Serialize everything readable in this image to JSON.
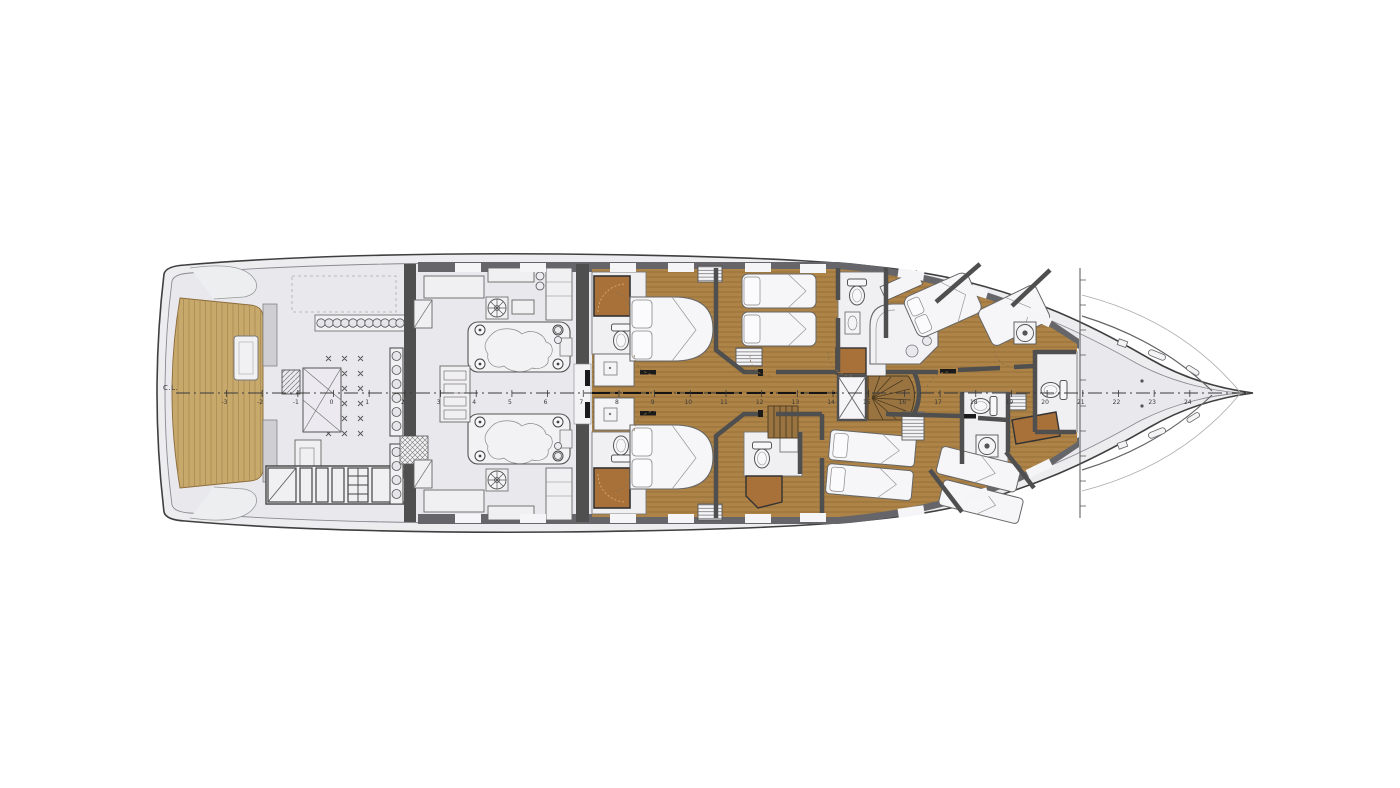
{
  "diagram": {
    "type": "yacht-lower-deck-plan",
    "centerline_label": "C.L.",
    "stations": [
      "-3",
      "-2",
      "-1",
      "0",
      "1",
      "2",
      "3",
      "4",
      "5",
      "6",
      "7",
      "8",
      "9",
      "10",
      "11",
      "12",
      "13",
      "14",
      "15",
      "16",
      "17",
      "18",
      "19",
      "20",
      "21",
      "22",
      "23",
      "24"
    ],
    "station_axis": {
      "origin_x": 333.5,
      "spacing_px": 35.68,
      "min_x": 178,
      "max_x": 1244,
      "centerline_y": 393
    }
  },
  "regions": [
    {
      "id": "swim-platform",
      "label": "teak swim platform"
    },
    {
      "id": "aft-deck",
      "label": "lazarette / tender bay"
    },
    {
      "id": "engine-room",
      "label": "engine room, twin engines"
    },
    {
      "id": "vip-cabins",
      "label": "two double cabins with en-suites"
    },
    {
      "id": "twin-cabins",
      "label": "twin guest cabins"
    },
    {
      "id": "stair-lobby",
      "label": "staircase lobby"
    },
    {
      "id": "crew-area",
      "label": "crew cabins, mess and laundry"
    },
    {
      "id": "bow",
      "label": "bow / forepeak"
    }
  ],
  "icons": {
    "toilet": "toilet-icon",
    "sink": "sink-icon",
    "washer": "washing-machine-icon",
    "fan": "engine-fan-icon",
    "bed": "bed-icon",
    "stairs": "stairs-icon",
    "hatch": "hatch-icon"
  },
  "colors": {
    "teak": "#c8a96c",
    "teak_grain": "#a98a52",
    "cabin_wood": "#ad8347",
    "cabin_wood_grain": "#6e5226",
    "stair_wood": "#9a7440",
    "hull_fill": "#edecef",
    "interior_fill": "#e9e8ec",
    "wall_dark": "#4f4f4f",
    "band_dark": "#66666a",
    "outline": "#3f3f3f",
    "furniture": "#f4f3f6",
    "shower_brown": "#a9713a"
  }
}
